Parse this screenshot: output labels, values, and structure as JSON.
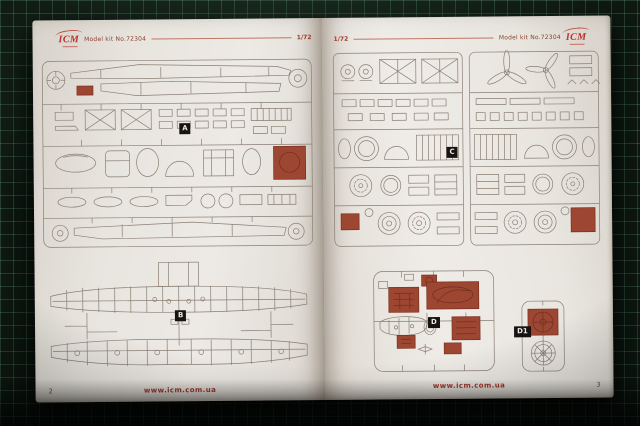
{
  "colors": {
    "accent_red": "#a93c2b",
    "shaded_part_red": "#9d4733",
    "mat_base": "#0f1b13",
    "mat_grid": "#6ea587",
    "paper": "#e9e6e0",
    "sprue_line": "#8a7e73",
    "label_bg": "#161310"
  },
  "left_page": {
    "header": {
      "logo_text": "ICM",
      "kit_label": "Model kit No.72304",
      "scale_label": "1/72"
    },
    "sprue_labels": {
      "a": "A",
      "b": "B"
    },
    "footer": {
      "page_number": "2",
      "website": "www.icm.com.ua"
    }
  },
  "right_page": {
    "header": {
      "scale_label": "1/72",
      "kit_label": "Model kit No.72304",
      "logo_text": "ICM"
    },
    "sprue_labels": {
      "c": "C",
      "d": "D",
      "d1": "D1"
    },
    "footer": {
      "page_number": "3",
      "website": "www.icm.com.ua"
    }
  }
}
